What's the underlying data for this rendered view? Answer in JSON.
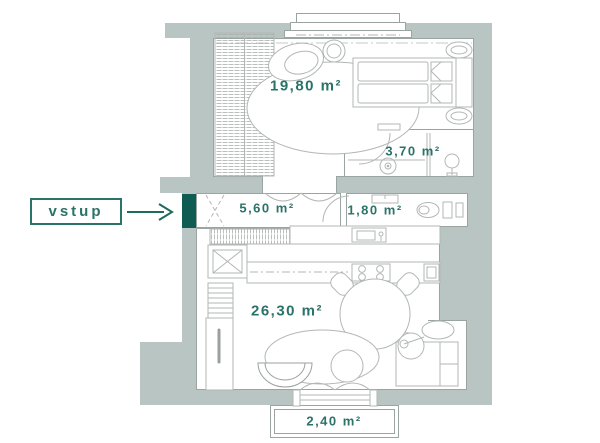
{
  "entrance": {
    "label": "vstup"
  },
  "rooms": {
    "bedroom": {
      "area": "19,80 m²"
    },
    "bathroom": {
      "area": "3,70 m²"
    },
    "hallway": {
      "area": "5,60 m²"
    },
    "wc": {
      "area": "1,80 m²"
    },
    "living": {
      "area": "26,30 m²"
    },
    "balcony": {
      "area": "2,40 m²"
    }
  },
  "colors": {
    "wall": "#b9c5c2",
    "label_text": "#2b7268",
    "entrance_door": "#0e5c52",
    "furniture_line": "#b2b7b5"
  }
}
